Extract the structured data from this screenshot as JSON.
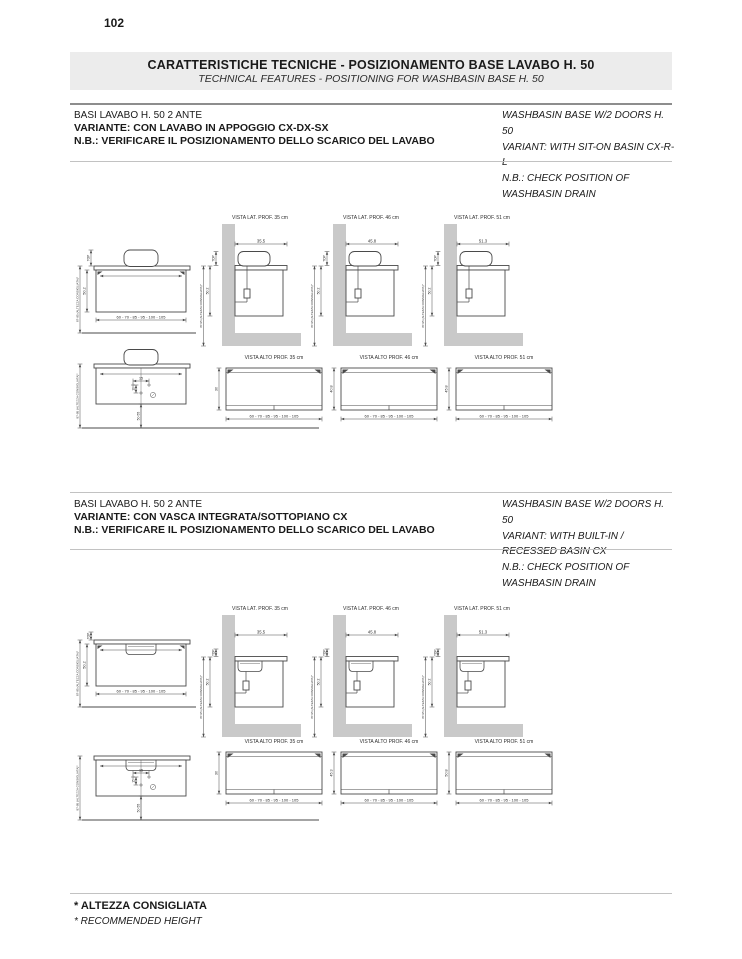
{
  "page_number": "102",
  "header": {
    "title": "CARATTERISTICHE TECNICHE - POSIZIONAMENTO BASE LAVABO H. 50",
    "subtitle": "TECHNICAL FEATURES - POSITIONING FOR WASHBASIN BASE H. 50"
  },
  "colors": {
    "band_bg": "#ececec",
    "wall_gray": "#c9c9c9",
    "line": "#4a4a4a",
    "text": "#2e2e2e"
  },
  "sections": [
    {
      "heading": {
        "it": [
          "BASI LAVABO H. 50 2 ANTE",
          "VARIANTE: CON LAVABO IN APPOGGIO CX-DX-SX",
          "N.B.: VERIFICARE IL POSIZIONAMENTO DELLO SCARICO DEL LAVABO"
        ],
        "en": [
          "WASHBASIN BASE W/2 DOORS H. 50",
          "VARIANT: WITH SIT-ON BASIN CX-R-L",
          "N.B.: CHECK POSITION OF WASHBASIN DRAIN"
        ]
      },
      "basin_type": "sit-on",
      "front_view": {
        "top_label": "TOP",
        "height": "50.2",
        "recommended_height": "87-95 (ALTEZZA CONSIGLIATA)*",
        "widths": "60 - 70 - 85 - 95 - 100 - 105"
      },
      "lateral_views": [
        {
          "label": "VISTA LAT. PROF. 35 cm",
          "depth": "35.5"
        },
        {
          "label": "VISTA LAT. PROF. 46 cm",
          "depth": "45.8"
        },
        {
          "label": "VISTA LAT. PROF. 51 cm",
          "depth": "51.3"
        }
      ],
      "drain_view": {
        "dim_a": "15",
        "dim_b": "10",
        "dim_c": "50-55",
        "recommended_height": "87-95 (ALTEZZA CONSIGLIATA)*"
      },
      "top_views": [
        {
          "label": "VISTA ALTO PROF. 35 cm",
          "depth": "30",
          "widths": "60 - 70 - 85 - 95 - 100 - 105"
        },
        {
          "label": "VISTA ALTO PROF. 46 cm",
          "depth": "40.8",
          "widths": "60 - 70 - 85 - 95 - 100 - 105"
        },
        {
          "label": "VISTA ALTO PROF. 51 cm",
          "depth": "45.8",
          "widths": "60 - 70 - 85 - 95 - 100 - 105"
        }
      ]
    },
    {
      "heading": {
        "it": [
          "BASI LAVABO H. 50 2 ANTE",
          "VARIANTE: CON VASCA INTEGRATA/SOTTOPIANO CX",
          "N.B.: VERIFICARE IL POSIZIONAMENTO DELLO SCARICO DEL LAVABO"
        ],
        "en": [
          "WASHBASIN BASE W/2 DOORS H. 50",
          "VARIANT: WITH BUILT-IN / RECESSED BASIN CX",
          "N.B.: CHECK POSITION OF WASHBASIN DRAIN"
        ]
      },
      "basin_type": "integrated",
      "front_view": {
        "top_label": "TOP",
        "height": "50.2",
        "recommended_height": "87-95 (ALTEZZA CONSIGLIATA)*",
        "widths": "60 - 70 - 85 - 95 - 100 - 105"
      },
      "lateral_views": [
        {
          "label": "VISTA LAT. PROF. 35 cm",
          "depth": "35.5"
        },
        {
          "label": "VISTA LAT. PROF. 46 cm",
          "depth": "45.8"
        },
        {
          "label": "VISTA LAT. PROF. 51 cm",
          "depth": "51.3"
        }
      ],
      "drain_view": {
        "dim_a": "15",
        "dim_b": "15",
        "dim_c": "50-55",
        "recommended_height": "87-95 (ALTEZZA CONSIGLIATA)*"
      },
      "top_views": [
        {
          "label": "VISTA ALTO PROF. 35 cm",
          "depth": "30",
          "widths": "60 - 70 - 85 - 95 - 100 - 105"
        },
        {
          "label": "VISTA ALTO PROF. 46 cm",
          "depth": "45.3",
          "widths": "60 - 70 - 85 - 95 - 100 - 105"
        },
        {
          "label": "VISTA ALTO PROF. 51 cm",
          "depth": "50.8",
          "widths": "60 - 70 - 85 - 95 - 100 - 105"
        }
      ]
    }
  ],
  "footer": {
    "it": "* ALTEZZA CONSIGLIATA",
    "en": "* RECOMMENDED HEIGHT"
  }
}
